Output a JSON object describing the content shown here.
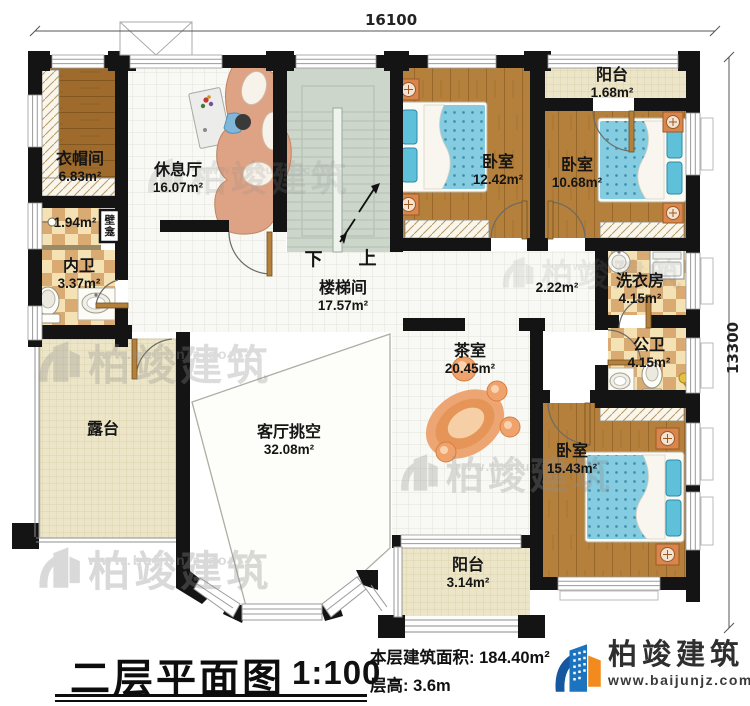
{
  "dimensions": {
    "width": "16100",
    "height": "13300"
  },
  "rooms": {
    "cloakroom": {
      "name": "衣帽间",
      "area": "6.83m²"
    },
    "lounge": {
      "name": "休息厅",
      "area": "16.07m²"
    },
    "bedroom1": {
      "name": "卧室",
      "area": "12.42m²"
    },
    "balcony_top": {
      "name": "阳台",
      "area": "1.68m²"
    },
    "bedroom2": {
      "name": "卧室",
      "area": "10.68m²"
    },
    "shower": {
      "area": "1.94m²"
    },
    "niche": {
      "name": "壁龛"
    },
    "bath_private": {
      "name": "内卫",
      "area": "3.37m²"
    },
    "stairwell": {
      "name": "楼梯间",
      "area": "17.57m²"
    },
    "hallway": {
      "area": "2.22m²"
    },
    "laundry": {
      "name": "洗衣房",
      "area": "4.15m²"
    },
    "bath_public": {
      "name": "公卫",
      "area": "4.15m²"
    },
    "tea_room": {
      "name": "茶室",
      "area": "20.45m²"
    },
    "terrace": {
      "name": "露台"
    },
    "living_void": {
      "name": "客厅挑空",
      "area": "32.08m²"
    },
    "bedroom3": {
      "name": "卧室",
      "area": "15.43m²"
    },
    "balcony_bottom": {
      "name": "阳台",
      "area": "3.14m²"
    }
  },
  "stairs": {
    "down": "下",
    "up": "上"
  },
  "title": {
    "name": "二层平面图",
    "scale": "1:100",
    "area_label": "本层建筑面积:",
    "area_value": "184.40m²",
    "floor_height_label": "层高:",
    "floor_height_value": "3.6m"
  },
  "brand": {
    "name": "柏竣建筑",
    "website": "www.baijunjz.com"
  },
  "watermark": {
    "text": "柏竣建筑",
    "subtext": "www.baijunjz.com"
  },
  "colors": {
    "wall": "#141414",
    "wood": "#b5803c",
    "wood_dark": "#9e6b2c",
    "checker": "#dcae72",
    "tile_line": "#e3e3db",
    "cream": "#ede6c9",
    "stairs": "#ccd6ca",
    "bed": "#85cce0",
    "brand_blue": "#1b74bd",
    "brand_orange": "#f28a1d"
  }
}
